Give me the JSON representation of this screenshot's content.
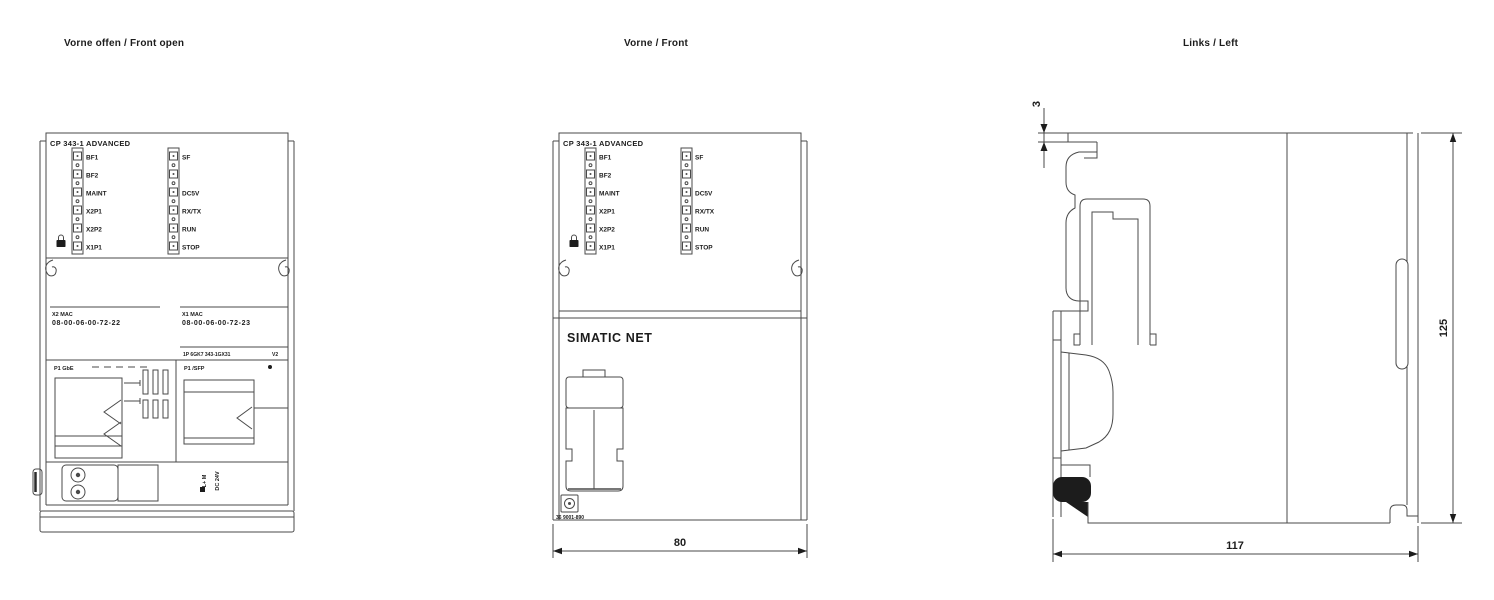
{
  "titles": {
    "front_open": "Vorne offen / Front open",
    "front": "Vorne / Front",
    "left": "Links / Left"
  },
  "module": {
    "model": "CP 343-1 ADVANCED",
    "brand": "SIMATIC NET",
    "leds": {
      "left": [
        "BF1",
        "BF2",
        "MAINT",
        "X2P1",
        "X2P2",
        "X1P1"
      ],
      "right": [
        "SF",
        "DC5V",
        "RX/TX",
        "RUN",
        "STOP"
      ]
    },
    "icons": {
      "lock": "padlock",
      "power_marker": "filled-square",
      "screw": "slotted-screw"
    }
  },
  "front_open_view": {
    "mac_a_label": "X2 MAC",
    "mac_a_value": "08-00-06-00-72-22",
    "mac_b_label": "X1 MAC",
    "mac_b_value": "08-00-06-00-72-23",
    "order_line": "1P 6GK7 343-1GX31",
    "version": "V2",
    "port_a_header": "P1 GbE",
    "port_b_header": "P1 /SFP",
    "power_terminals": "L+  M",
    "power_voltage": "DC 24V"
  },
  "front_view": {
    "article_no": "36 9001-890"
  },
  "dimensions": {
    "front_width_mm": "80",
    "side_depth_mm": "117",
    "side_height_mm": "125",
    "top_ledge_mm": "3"
  },
  "colors": {
    "line": "#4a4a4a",
    "ink": "#1c1c1c",
    "background": "#ffffff"
  }
}
